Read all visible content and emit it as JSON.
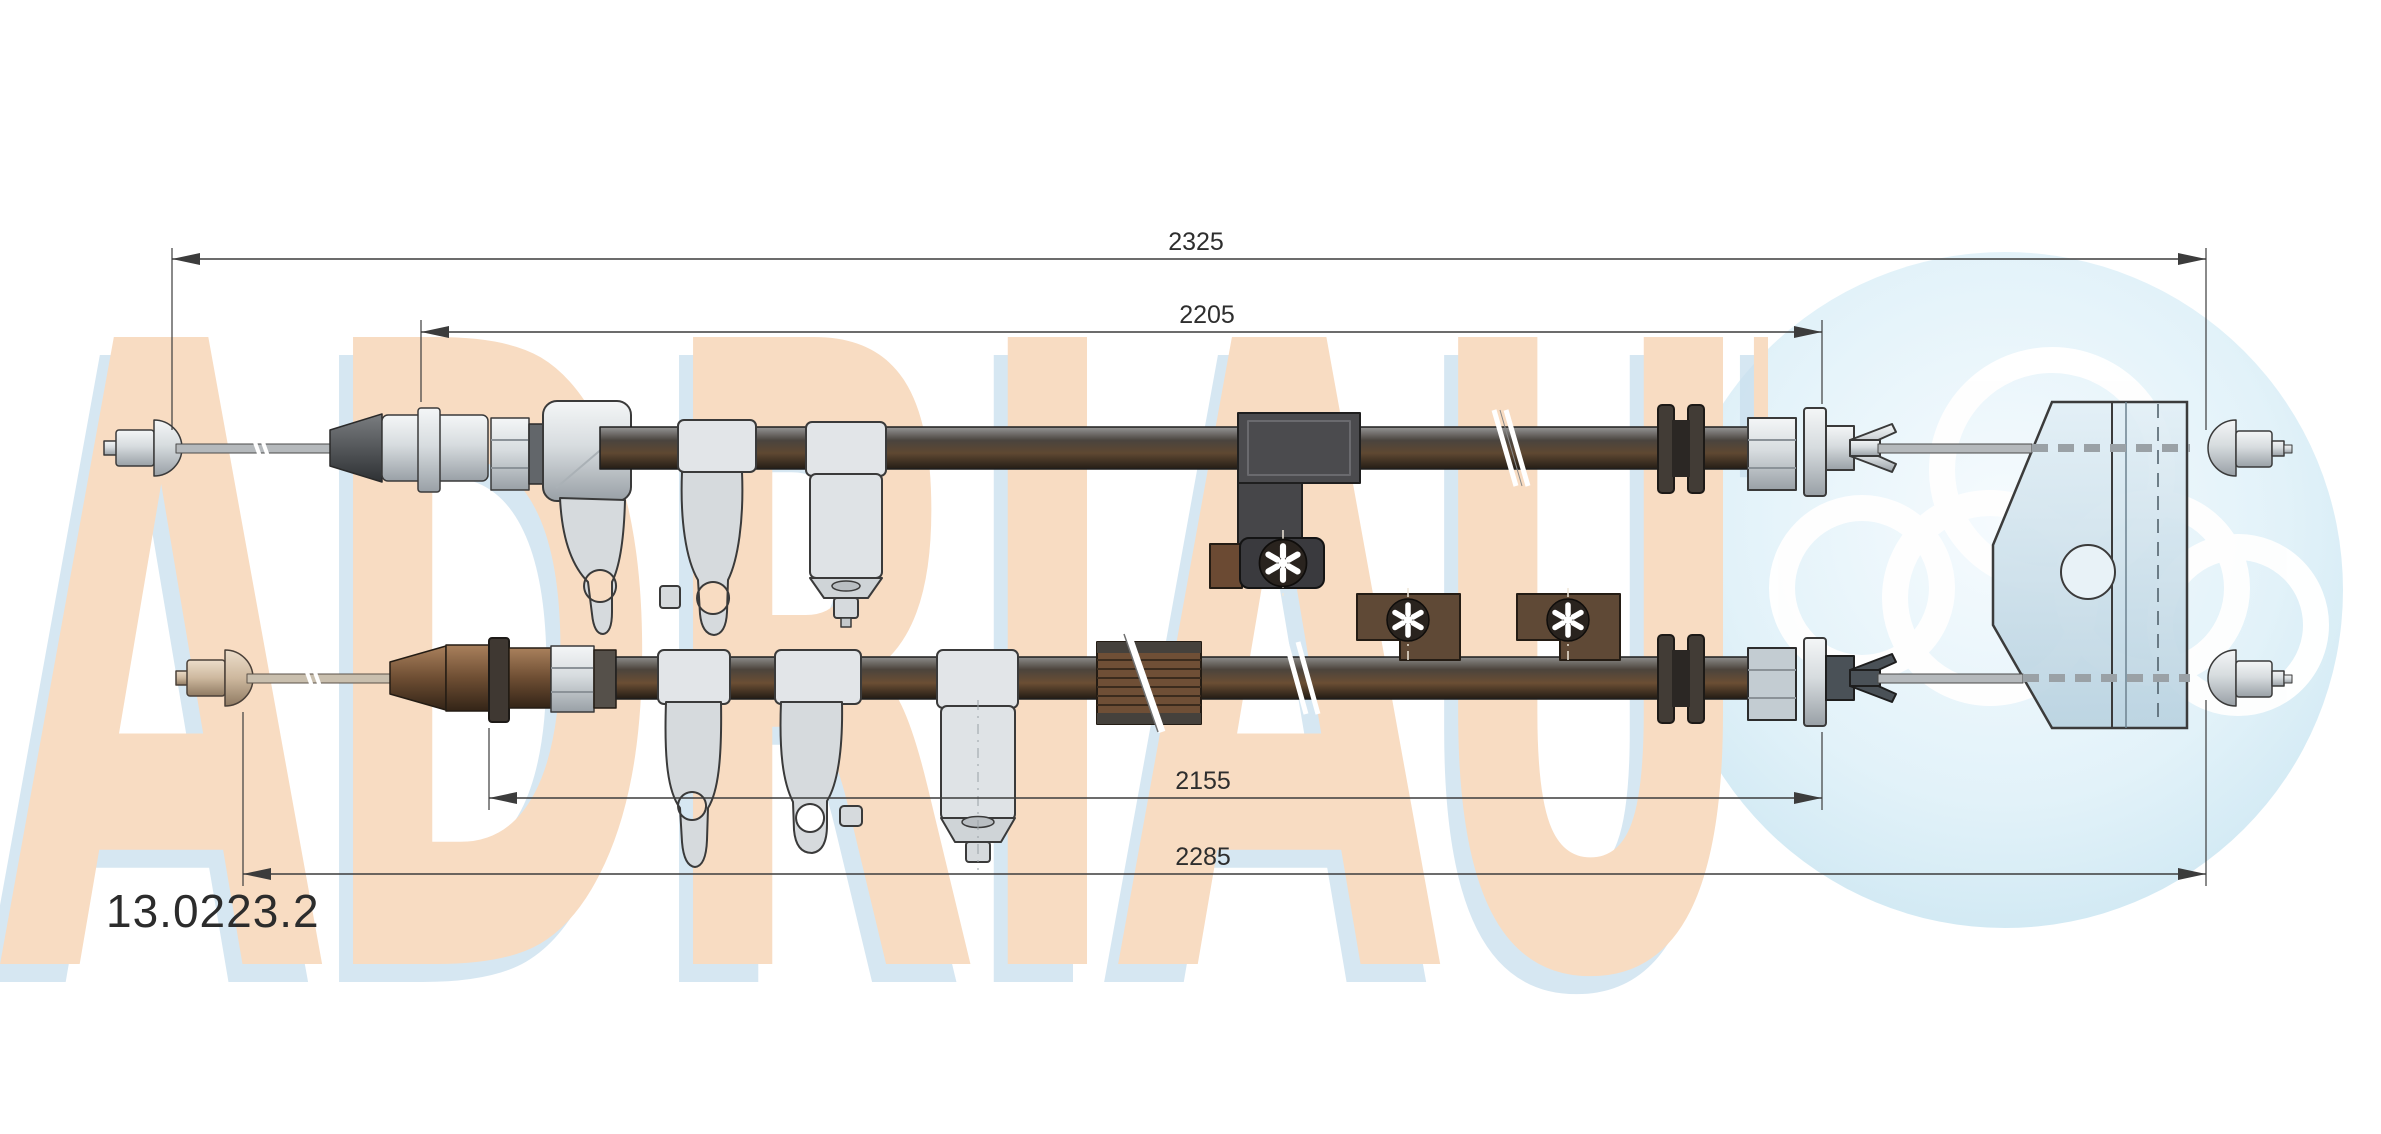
{
  "page": {
    "background_color": "#ffffff",
    "type": "technical-part-drawing"
  },
  "diagram": {
    "part_number": "13.0223.2",
    "subject": "parking-brake-cable-two-runs",
    "dimensions": [
      {
        "id": "upper-overall",
        "value": "2325"
      },
      {
        "id": "upper-sheath",
        "value": "2205"
      },
      {
        "id": "lower-sheath",
        "value": "2155"
      },
      {
        "id": "lower-overall",
        "value": "2285"
      }
    ],
    "line_color": "#3c3c3c",
    "label_color": "#2e2e2e"
  },
  "watermark": {
    "brand_text": "ADRIAUTO",
    "letter_color": "#f8dcc2",
    "shadow_color": "#c9dfee"
  },
  "logo": {
    "circle_color": "#d9edf7",
    "rings_color": "#ffffff"
  }
}
